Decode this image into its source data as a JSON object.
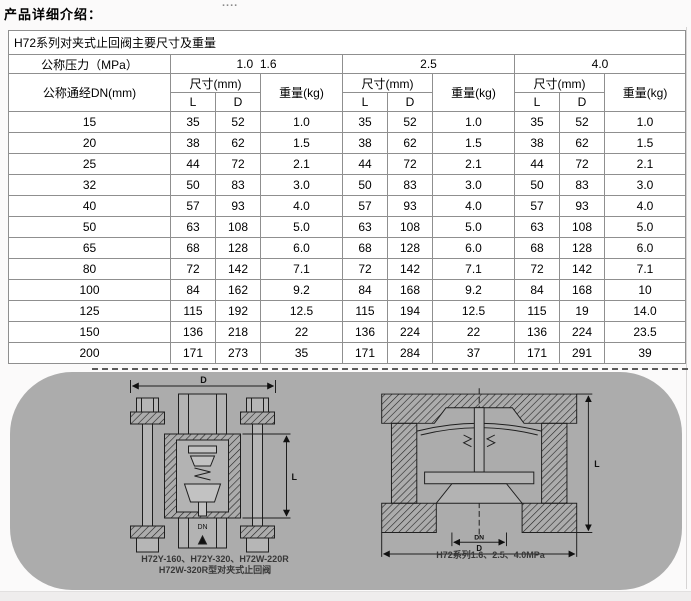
{
  "page": {
    "title": "产品详细介绍：",
    "dots": "...."
  },
  "table": {
    "caption": "H72系列对夹式止回阀主要尺寸及重量",
    "pressure_label": "公称压力（MPa）",
    "dn_label": "公称通经DN(mm)",
    "size_label": "尺寸(mm)",
    "weight_label": "重量(kg)",
    "l_label": "L",
    "d_label": "D",
    "groups": [
      "1.0  1.6",
      "2.5",
      "4.0"
    ],
    "rows": [
      {
        "dn": "15",
        "cells": [
          "35",
          "52",
          "1.0",
          "35",
          "52",
          "1.0",
          "35",
          "52",
          "1.0"
        ]
      },
      {
        "dn": "20",
        "cells": [
          "38",
          "62",
          "1.5",
          "38",
          "62",
          "1.5",
          "38",
          "62",
          "1.5"
        ]
      },
      {
        "dn": "25",
        "cells": [
          "44",
          "72",
          "2.1",
          "44",
          "72",
          "2.1",
          "44",
          "72",
          "2.1"
        ]
      },
      {
        "dn": "32",
        "cells": [
          "50",
          "83",
          "3.0",
          "50",
          "83",
          "3.0",
          "50",
          "83",
          "3.0"
        ]
      },
      {
        "dn": "40",
        "cells": [
          "57",
          "93",
          "4.0",
          "57",
          "93",
          "4.0",
          "57",
          "93",
          "4.0"
        ]
      },
      {
        "dn": "50",
        "cells": [
          "63",
          "108",
          "5.0",
          "63",
          "108",
          "5.0",
          "63",
          "108",
          "5.0"
        ]
      },
      {
        "dn": "65",
        "cells": [
          "68",
          "128",
          "6.0",
          "68",
          "128",
          "6.0",
          "68",
          "128",
          "6.0"
        ]
      },
      {
        "dn": "80",
        "cells": [
          "72",
          "142",
          "7.1",
          "72",
          "142",
          "7.1",
          "72",
          "142",
          "7.1"
        ]
      },
      {
        "dn": "100",
        "cells": [
          "84",
          "162",
          "9.2",
          "84",
          "168",
          "9.2",
          "84",
          "168",
          "10"
        ]
      },
      {
        "dn": "125",
        "cells": [
          "115",
          "192",
          "12.5",
          "115",
          "194",
          "12.5",
          "115",
          "19",
          "14.0"
        ]
      },
      {
        "dn": "150",
        "cells": [
          "136",
          "218",
          "22",
          "136",
          "224",
          "22",
          "136",
          "224",
          "23.5"
        ]
      },
      {
        "dn": "200",
        "cells": [
          "171",
          "273",
          "35",
          "171",
          "284",
          "37",
          "171",
          "291",
          "39"
        ]
      }
    ]
  },
  "figure": {
    "left_caption_line1": "H72Y-160、H72Y-320、H72W-220R",
    "left_caption_line2": "H72W-320R型对夹式止回阀",
    "right_caption": "H72系列1.6、2.5、4.0MPa",
    "dim_d": "D",
    "dim_l": "L",
    "dim_dn": "DN"
  },
  "colors": {
    "figure_bg": "#acacac",
    "table_border": "#8f8f8f",
    "line": "#1e1e1e"
  }
}
